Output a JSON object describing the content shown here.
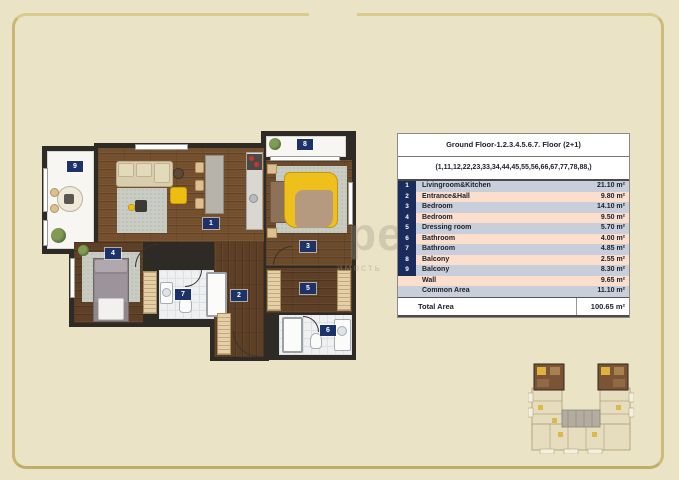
{
  "table": {
    "title": "Ground Floor-1.2.3.4.5.6.7. Floor (2+1)",
    "subtitle": "(1,11,12,22,23,33,34,44,45,55,56,66,67,77,78,88,)",
    "rows": [
      {
        "no": "1",
        "label": "Livingroom&Kitchen",
        "area": "21.10 m²"
      },
      {
        "no": "2",
        "label": "Entrance&Hall",
        "area": "9.80 m²"
      },
      {
        "no": "3",
        "label": "Bedroom",
        "area": "14.10 m²"
      },
      {
        "no": "4",
        "label": "Bedroom",
        "area": "9.50 m²"
      },
      {
        "no": "5",
        "label": "Dressing room",
        "area": "5.70 m²"
      },
      {
        "no": "6",
        "label": "Bathroom",
        "area": "4.00 m²"
      },
      {
        "no": "7",
        "label": "Bathroom",
        "area": "4.85 m²"
      },
      {
        "no": "8",
        "label": "Balcony",
        "area": "2.55 m²"
      },
      {
        "no": "9",
        "label": "Balcony",
        "area": "8.30 m²"
      },
      {
        "no": "",
        "label": "Wall",
        "area": "9.65 m²"
      },
      {
        "no": "",
        "label": "Common Area",
        "area": "11.10 m²"
      }
    ],
    "total_label": "Total Area",
    "total_area": "100.65 m²"
  },
  "floorplan": {
    "rooms": [
      {
        "number": "1"
      },
      {
        "number": "2"
      },
      {
        "number": "3"
      },
      {
        "number": "4"
      },
      {
        "number": "5"
      },
      {
        "number": "6"
      },
      {
        "number": "7"
      },
      {
        "number": "8"
      },
      {
        "number": "9"
      }
    ]
  },
  "watermark": {
    "big": "pe",
    "small": "имость"
  },
  "colors": {
    "background": "#ebe3c5",
    "frame_gold": "#d3c27f",
    "table_navy": "#1b2b5c",
    "row_blue": "#c8cfdb",
    "row_pink": "#fcdecd",
    "badge_navy": "#1d3268",
    "wood": "#75502f",
    "highlight_unit": "#7b5436"
  }
}
